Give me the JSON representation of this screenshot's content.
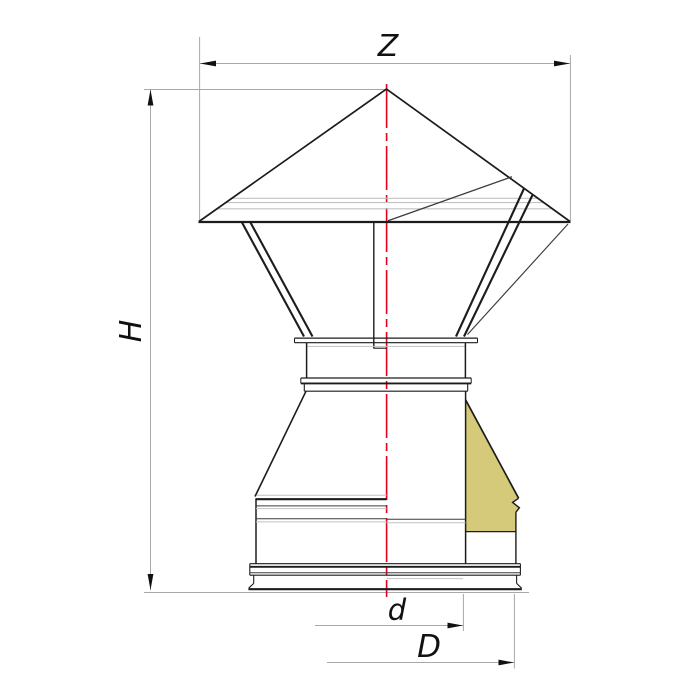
{
  "drawing": {
    "type": "technical-drawing",
    "view": "half-section-front-view"
  },
  "dimensions": {
    "width_top": {
      "label": "Z"
    },
    "height": {
      "label": "H"
    },
    "inner_diameter": {
      "label": "d"
    },
    "outer_diameter": {
      "label": "D"
    }
  },
  "colors": {
    "background": "#ffffff",
    "outline_dark": "#1c1c1c",
    "outline_medium": "#3c3c3c",
    "line_light": "#c2c2c2",
    "dim_line": "#a8a8a8",
    "arrow": "#111111",
    "label": "#111111",
    "centerline_red": "#e8001e",
    "insulation": "#d5ca79"
  }
}
